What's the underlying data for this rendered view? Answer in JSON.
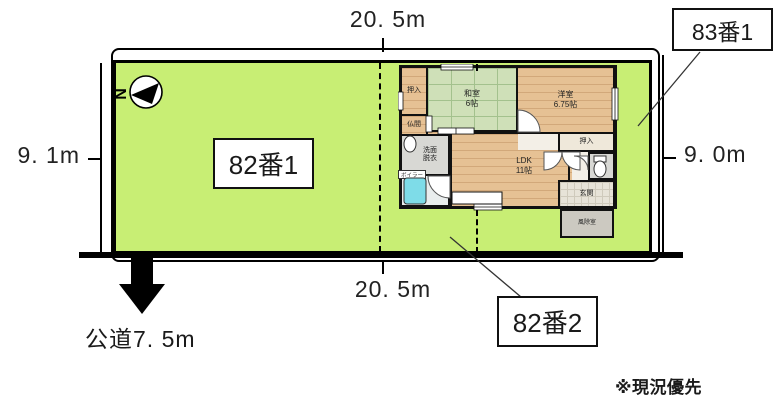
{
  "dimensions": {
    "top": "20. 5m",
    "bottom": "20. 5m",
    "left": "9. 1m",
    "right": "9. 0m",
    "road": "公道7. 5m"
  },
  "parcels": {
    "p82_1": "82番1",
    "p82_2": "82番2",
    "p83_1": "83番1"
  },
  "compass": {
    "north": "N"
  },
  "floorplan": {
    "rooms": {
      "oshiire_top": "押入",
      "washitsu": "和室\n6帖",
      "youshitsu": "洋室\n6.75帖",
      "butsuma": "仏間",
      "senmen": "洗面\n脱衣",
      "boiler": "ボイラー",
      "ldk": "LDK\n11帖",
      "oshiire_right": "押入",
      "genkan": "玄関",
      "fujoshitsu": "風除室"
    }
  },
  "note": "※現況優先",
  "colors": {
    "land_green": "#c8ee74",
    "tatami_green": "#cfe0b8",
    "wood_floor": "#e6c194",
    "gray_room": "#d8d8d4",
    "bathtub_cyan": "#7edce8",
    "line_black": "#000000"
  }
}
